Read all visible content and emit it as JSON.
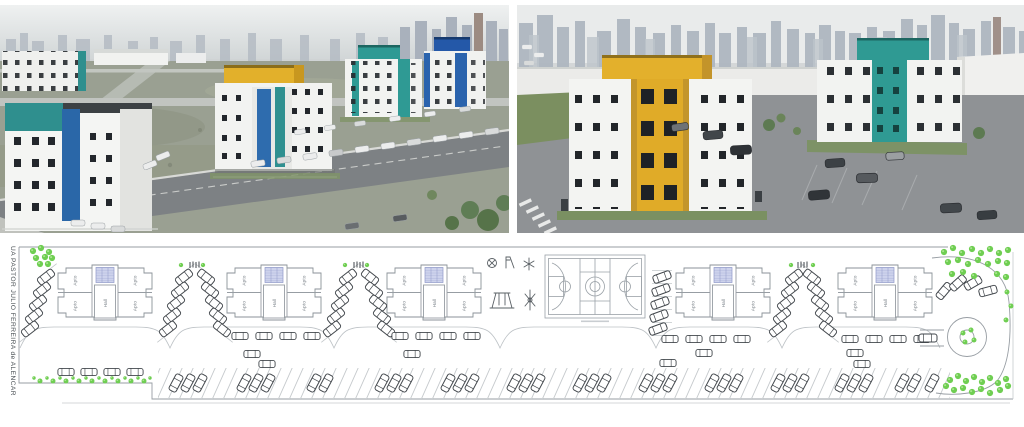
{
  "site_plan": {
    "street_label": "UA PASTOR JULIO FERREIRA de ALENCAR",
    "unit_label": "Apto",
    "hall_label": "Hall",
    "building_count": 5
  },
  "palette": {
    "teal_accent": "#2f9a93",
    "yellow_accent": "#e2b02b",
    "blue_accent": "#2a67a8",
    "tree_green": "#6fce52",
    "plan_line_gray": "#979da3",
    "stairwell_blue": "#cdd2ec",
    "asphalt": "#7d8184"
  }
}
